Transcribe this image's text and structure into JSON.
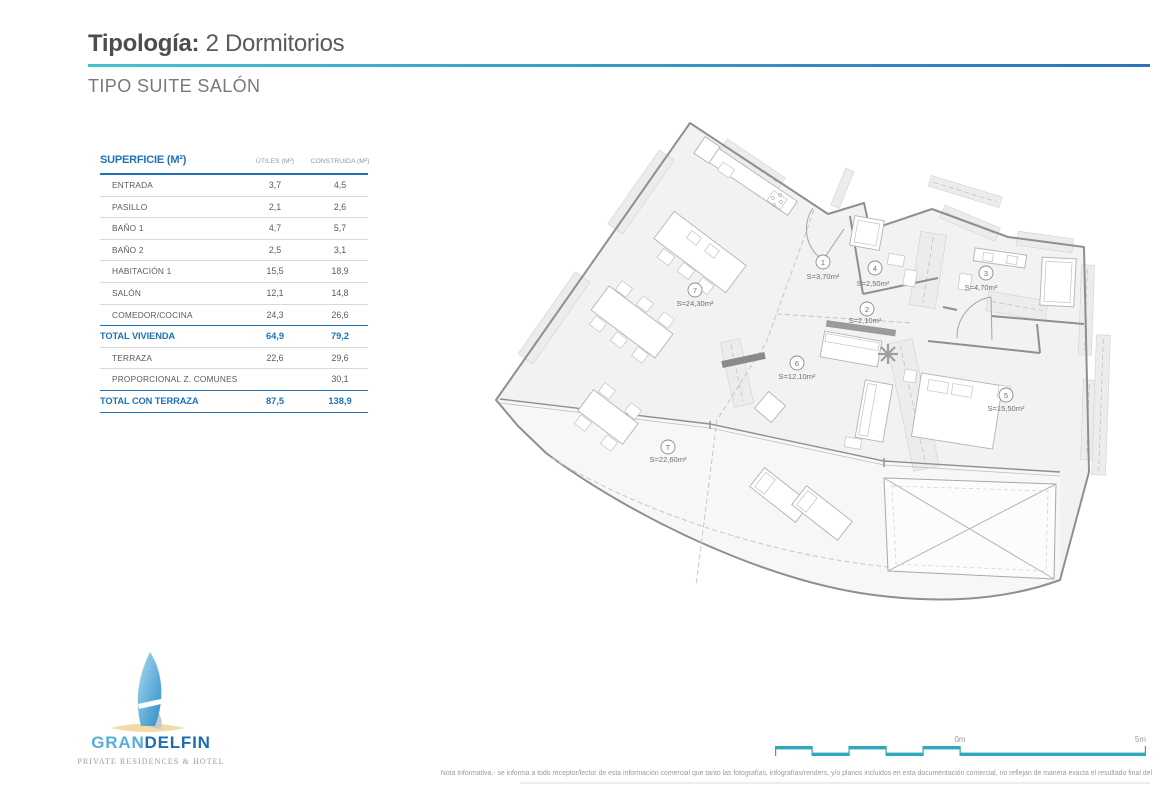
{
  "header": {
    "title_bold": "Tipología:",
    "title_rest": " 2 Dormitorios",
    "subtitle": "TIPO SUITE SALÓN"
  },
  "table": {
    "title": "SUPERFICIE (M²)",
    "col_utiles": "ÚTILES (M²)",
    "col_construida": "CONSTRUIDA (M²)",
    "rows": [
      {
        "label": "ENTRADA",
        "utiles": "3,7",
        "construida": "4,5"
      },
      {
        "label": "PASILLO",
        "utiles": "2,1",
        "construida": "2,6"
      },
      {
        "label": "BAÑO 1",
        "utiles": "4,7",
        "construida": "5,7"
      },
      {
        "label": "BAÑO 2",
        "utiles": "2,5",
        "construida": "3,1"
      },
      {
        "label": "HABITACIÓN 1",
        "utiles": "15,5",
        "construida": "18,9"
      },
      {
        "label": "SALÓN",
        "utiles": "12,1",
        "construida": "14,8"
      },
      {
        "label": "COMEDOR/COCINA",
        "utiles": "24,3",
        "construida": "26,6"
      },
      {
        "label": "TOTAL VIVIENDA",
        "utiles": "64,9",
        "construida": "79,2"
      },
      {
        "label": "TERRAZA",
        "utiles": "22,6",
        "construida": "29,6"
      },
      {
        "label": "PROPORCIONAL Z. COMUNES",
        "utiles": "",
        "construida": "30,1"
      },
      {
        "label": "TOTAL CON TERRAZA",
        "utiles": "87,5",
        "construida": "138,9"
      }
    ]
  },
  "plan": {
    "rooms": [
      {
        "num": "1",
        "area": "S=3,70m²"
      },
      {
        "num": "2",
        "area": "S=2,10m²"
      },
      {
        "num": "3",
        "area": "S=4,70m²"
      },
      {
        "num": "4",
        "area": "S=2,50m²"
      },
      {
        "num": "5",
        "area": "S=15,50m²"
      },
      {
        "num": "6",
        "area": "S=12,10m²"
      },
      {
        "num": "7",
        "area": "S=24,30m²"
      },
      {
        "num": "T",
        "area": "S=22,60m²"
      }
    ]
  },
  "scalebar": {
    "zero": "0m",
    "five": "5m"
  },
  "logo": {
    "gran": "GRAN",
    "delfin": "DELFIN",
    "tagline": "PRIVATE RESIDENCES & HOTEL"
  },
  "footer": {
    "note": "Nota Informativa.- se informa a todo receptor/lector de esta información comercial que tanto las fotografías, infografías/renders, y/o planos incluidos en esta documentación comercial, no reflejan de manera exacta el resultado final del"
  },
  "colors": {
    "teal": "#43c4cf",
    "blue": "#1e73b8",
    "light_blue": "#55add9",
    "dark_blue": "#1b6db3",
    "scalebar": "#2fa8bc"
  }
}
